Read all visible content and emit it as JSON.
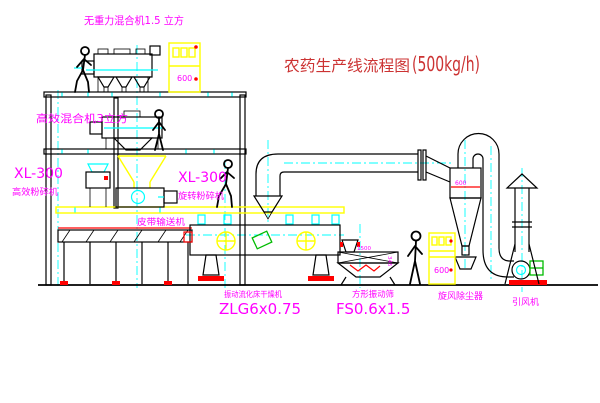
{
  "title": {
    "main": "农药生产线流程图",
    "capacity": "(500kg/h)"
  },
  "labels": {
    "gravity_mixer": "无重力混合机1.5 立方",
    "high_eff_mixer": "高效混合机3立方",
    "crusher_left_model": "XL-300",
    "crusher_left_name": "高效粉碎机",
    "crusher_mid_model": "XL-300",
    "crusher_mid_name": "旋转粉碎机",
    "belt_conveyor": "皮带输送机",
    "dryer_name": "振动流化床干燥机",
    "dryer_model": "ZLG6x0.75",
    "sieve_name": "方形振动筛",
    "sieve_model": "FS0.6x1.5",
    "cyclone_name": "旋风除尘器",
    "fan_name": "引风机"
  },
  "annotations": {
    "cyclone_dia": "600",
    "cabinet1_mark": "600",
    "cabinet2_mark": "600",
    "dim_length": "1500",
    "dim_height": "345"
  },
  "colors": {
    "background": "#ffffff",
    "line_black": "#000000",
    "structure_yellow": "#ffff00",
    "centerline_cyan": "#00ffff",
    "label_magenta": "#ff00ff",
    "accent_red": "#ff0000",
    "title_red": "#cc3333",
    "accent_green": "#00bb00"
  }
}
